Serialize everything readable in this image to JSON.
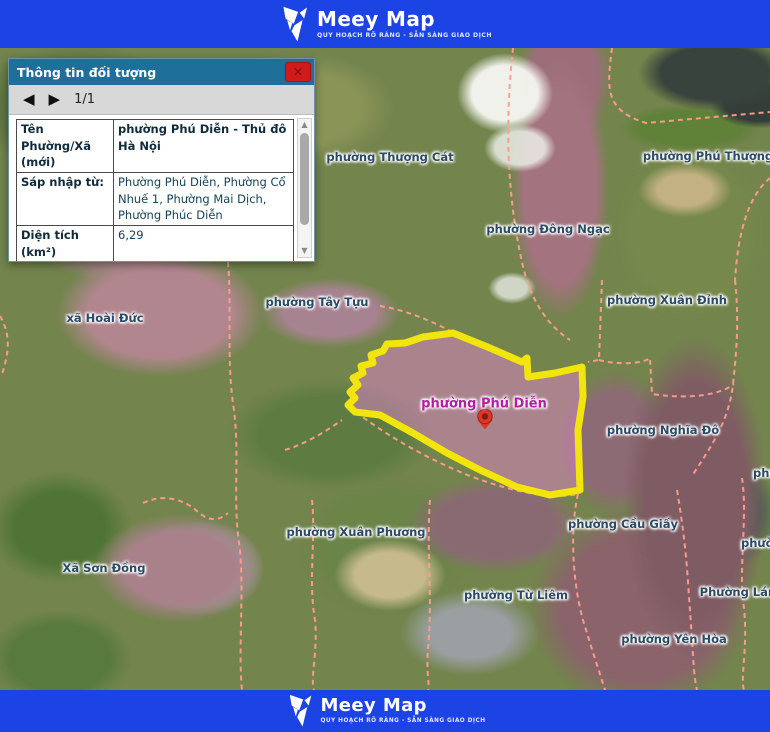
{
  "brand": {
    "name": "Meey Map",
    "tagline": "QUY HOẠCH RÕ RÀNG - SẴN SÀNG GIAO DỊCH"
  },
  "icons": {
    "close": "✕",
    "prev": "◀",
    "next": "▶",
    "scroll_up": "▲",
    "scroll_down": "▼"
  },
  "popup": {
    "title": "Thông tin đối tượng",
    "pager_text": "1/1",
    "rows": [
      {
        "label": "Tên Phường/Xã (mới)",
        "value": "phường Phú Diễn - Thủ đô Hà Nội"
      },
      {
        "label": "Sáp nhập từ:",
        "value": "Phường Phú Diễn, Phường Cổ Nhuế 1, Phường Mai Dịch, Phường Phúc Diễn"
      },
      {
        "label": "Diện tích (km²)",
        "value": "6,29"
      },
      {
        "label": "Dân số (người)",
        "value": "74.603"
      },
      {
        "label": "Trụ sở hành",
        "value": "Tổ dân phố số 10, phường Phú"
      }
    ]
  },
  "map": {
    "selected_ward": "phường Phú Diễn",
    "labels": [
      {
        "text": "phường Thượng Cát"
      },
      {
        "text": "phường Phú Thượng"
      },
      {
        "text": "phường Đông Ngạc"
      },
      {
        "text": "phường Xuân Đỉnh"
      },
      {
        "text": "phường Tây Tựu"
      },
      {
        "text": "xã Hoài Đức"
      },
      {
        "text": "phường Phú Diễn"
      },
      {
        "text": "phường Nghĩa Đô"
      },
      {
        "text": "phường Cầu Giấy"
      },
      {
        "text": "phường Xuân Phương"
      },
      {
        "text": "Xã Sơn Đồng"
      },
      {
        "text": "phường Từ Liêm"
      },
      {
        "text": "Phường Láng"
      },
      {
        "text": "phường Yên Hòa"
      },
      {
        "text": "phư"
      },
      {
        "text": "phườ"
      }
    ]
  },
  "colors": {
    "header_blue": "#1c43e3",
    "popup_titlebar": "#1e6f9a",
    "close_red": "#d11a1a",
    "boundary_dash": "#ff9d8d",
    "polygon_stroke": "#f2e50b",
    "polygon_fill": "rgba(225,130,205,0.5)",
    "selected_label": "#b41da4",
    "ward_label": "#2b4a66"
  }
}
